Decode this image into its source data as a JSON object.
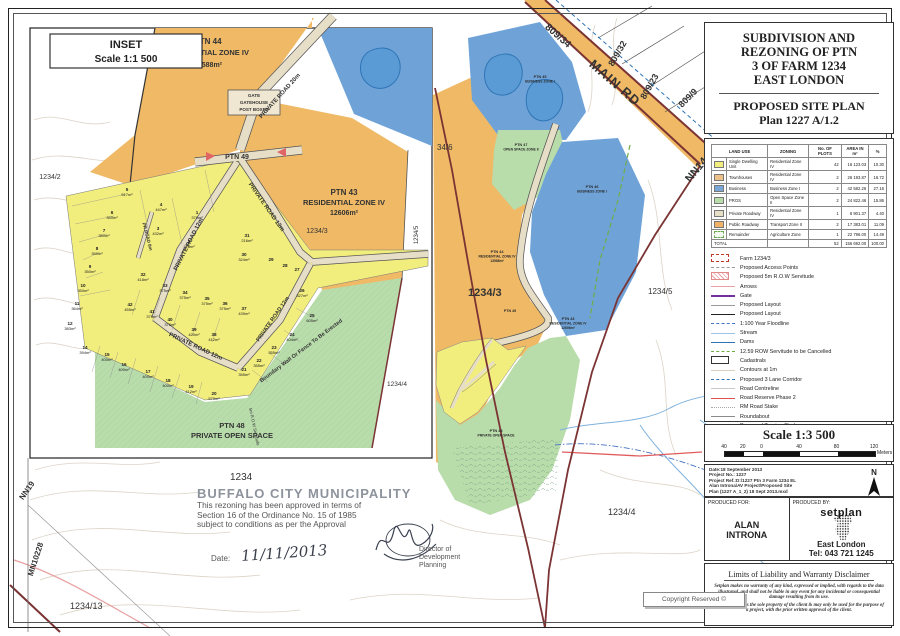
{
  "title_block": {
    "line1": "SUBDIVISION AND",
    "line2": "REZONING OF PTN",
    "line3": "3  OF FARM 1234",
    "line4": "EAST LONDON",
    "sub1": "PROPOSED SITE PLAN",
    "sub2": "Plan 1227 A/1.2"
  },
  "legend_table": {
    "headers": {
      "land_use": "LAND USE",
      "zoning": "ZONING",
      "plots": "No. OF PLOTS",
      "area": "AREA IN m²",
      "pct": "%"
    },
    "rows": [
      {
        "land_use": "Single Dwelling Unit",
        "zoning": "Residential Zone IV",
        "plots": "42",
        "area": "16 123.03",
        "pct": "10.30"
      },
      {
        "land_use": "Townhouses",
        "zoning": "Residential Zone IV",
        "plots": "2",
        "area": "26 193.87",
        "pct": "16.72"
      },
      {
        "land_use": "Business",
        "zoning": "Business Zone I",
        "plots": "2",
        "area": "42 582.26",
        "pct": "27.16"
      },
      {
        "land_use": "PROS",
        "zoning": "Open Space Zone II",
        "plots": "2",
        "area": "24 822.46",
        "pct": "15.86"
      },
      {
        "land_use": "Private Roadway",
        "zoning": "Residential Zone IV",
        "plots": "1",
        "area": "6 901.37",
        "pct": "4.40"
      },
      {
        "land_use": "Public Roadway",
        "zoning": "Transport Zone II",
        "plots": "2",
        "area": "17 383.01",
        "pct": "11.09"
      },
      {
        "land_use": "Remainder",
        "zoning": "Agriculture Zone",
        "plots": "1",
        "area": "22 796.00",
        "pct": "14.49"
      }
    ],
    "total": {
      "label": "TOTAL",
      "plots": "52",
      "area": "156 692.00",
      "pct": "100.00"
    }
  },
  "legend_items": [
    "Farm 1234/3",
    "Proposed Access Points",
    "Proposed 5m R.O.W Servitude",
    "Arrows",
    "Gate",
    "Proposed Layout",
    "Proposed Layout",
    "1:100 Year Floodline",
    "Stream",
    "Dams",
    "12.59 ROW Servitude to be Cancelled",
    "Cadastrals",
    "Contours at 1m",
    "Proposed 3 Lane Corridor",
    "Road Centreline",
    "Road Reserve Phase 2",
    "RM Road Stake",
    "Roundabout",
    "Proposed Turning Circle"
  ],
  "scale_bar": {
    "title": "Scale 1:3 500",
    "ticks": [
      "40",
      "20",
      "0",
      "40",
      "80",
      "120"
    ],
    "unit": "Meters"
  },
  "project_info": {
    "l1": "Date:18 September 2013",
    "l2": "Project No.: 1227",
    "l3": "Project Ref.:D:\\1227 Ptn 3 Farm 1234 EL",
    "l4": "Alan Introna\\AV Project\\Proposed Site",
    "l5": "Plan (1227 A_1_2) 18 Sept 2013.mxd",
    "north": "N"
  },
  "produced": {
    "for_label": "PRODUCED FOR:",
    "for_line1": "ALAN",
    "for_line2": "INTRONA",
    "by_label": "PRODUCED BY:",
    "logo": "setplan",
    "city": "East London",
    "tel": "Tel: 043 721 1245"
  },
  "disclaimer": {
    "title": "Limits of Liability and Warranty Disclaimer",
    "p1": "Setplan makes no warranty of any kind, expressed or implied, with regards to the data illustrated, and shall not be liable in any event for any incidental or consequential damage resulting from its use.",
    "p2": "The data remains the sole property of the client & may only be used for the purpose of a project, with the prior written approval of the client."
  },
  "approval": {
    "title": "BUFFALO CITY MUNICIPALITY",
    "l1": "This rezoning has been approved in terms of",
    "l2": "Section 16 of the Ordinance No. 15 of 1985",
    "l3": "subject to conditions as per the Approval",
    "date_label": "Date:",
    "date_value": "11/11/2013",
    "signer1": "Director of",
    "signer2": "Development Planning"
  },
  "copyright": "Copyright Reserved ©",
  "inset": {
    "title": "INSET",
    "scale": "Scale 1:1 500",
    "ptn44": {
      "l1": "PTN 44",
      "l2": "RESIDENTIAL ZONE IV",
      "l3": "13588m²"
    },
    "ptn43": {
      "l1": "PTN 43",
      "l2": "RESIDENTIAL ZONE IV",
      "l3": "12606m²"
    },
    "ptn48": {
      "l1": "PTN 48",
      "l2": "PRIVATE OPEN SPACE"
    },
    "ptn49": "PTN 49",
    "gate": {
      "l1": "GATE",
      "l2": "GATEHOUSE",
      "l3": "POST BOXES"
    },
    "roads": {
      "r20": "PRIVATE ROAD 20m",
      "r12": "PRIVATE ROAD 12m",
      "r8": "PR ROAD 8m"
    },
    "servitude": "5m R.O.W Servitude",
    "boundary_wall": "Boundary Wall Or Fence To Be Erected",
    "neighbors": {
      "n1234_6": "1234/6",
      "n1234_2": "1234/2",
      "n1234_3": "1234/3",
      "n1234_4": "1234/4",
      "n1234_5": "1234/5"
    },
    "lots": [
      {
        "n": "1",
        "a": "379m²"
      },
      {
        "n": "2",
        "a": "328m²"
      },
      {
        "n": "3",
        "a": "432m²"
      },
      {
        "n": "4",
        "a": "447m²"
      },
      {
        "n": "5",
        "a": "517m²"
      },
      {
        "n": "6",
        "a": "350m²"
      },
      {
        "n": "7",
        "a": "350m²"
      },
      {
        "n": "8",
        "a": "350m²"
      },
      {
        "n": "9",
        "a": "350m²"
      },
      {
        "n": "10",
        "a": "350m²"
      },
      {
        "n": "11",
        "a": "364m²"
      },
      {
        "n": "12",
        "a": "383m²"
      },
      {
        "n": "14",
        "a": "394m²"
      },
      {
        "n": "15",
        "a": "400m²"
      },
      {
        "n": "16",
        "a": "400m²"
      },
      {
        "n": "17",
        "a": "400m²"
      },
      {
        "n": "18",
        "a": "400m²"
      },
      {
        "n": "19",
        "a": "412m²"
      },
      {
        "n": "20",
        "a": "579m²"
      },
      {
        "n": "21",
        "a": "355m²"
      },
      {
        "n": "22",
        "a": "355m²"
      },
      {
        "n": "23",
        "a": "355m²"
      },
      {
        "n": "24",
        "a": "404m²"
      },
      {
        "n": "25",
        "a": "605m²"
      },
      {
        "n": "26",
        "a": "327m²"
      },
      {
        "n": "27",
        "a": ""
      },
      {
        "n": "28",
        "a": ""
      },
      {
        "n": "29",
        "a": ""
      },
      {
        "n": "30",
        "a": "324m²"
      },
      {
        "n": "31",
        "a": "216m²"
      },
      {
        "n": "32",
        "a": "418m²"
      },
      {
        "n": "33",
        "a": "375m²"
      },
      {
        "n": "34",
        "a": "375m²"
      },
      {
        "n": "35",
        "a": "375m²"
      },
      {
        "n": "36",
        "a": "375m²"
      },
      {
        "n": "37",
        "a": "439m²"
      },
      {
        "n": "38",
        "a": "412m²"
      },
      {
        "n": "39",
        "a": "420m²"
      },
      {
        "n": "40",
        "a": "375m²"
      },
      {
        "n": "41",
        "a": "375m²"
      },
      {
        "n": "42",
        "a": "455m²"
      }
    ]
  },
  "map": {
    "main_rd": "MAIN RD",
    "p809_34": "809/34",
    "p809_32": "809/32",
    "p809_23": "809/23",
    "p809_9": "809/9",
    "nn14": "NN14",
    "nn19": "NN19",
    "mn10228": "MN10228",
    "p34_6": "34/6",
    "p1234": "1234",
    "p1234_3": "1234/3",
    "p1234_4": "1234/4",
    "p1234_4b": "1234/4",
    "p1234_5": "1234/5",
    "p1234_13": "1234/13",
    "z45": {
      "l1": "PTN 45",
      "l2": "BUSINESS ZONE I"
    },
    "z46": {
      "l1": "PTN 46",
      "l2": "BUSINESS ZONE I"
    },
    "z47": {
      "l1": "PTN 47",
      "l2": "OPEN SPACE ZONE II"
    },
    "z44": {
      "l1": "PTN 44",
      "l2": "RESIDENTIAL ZONE IV",
      "l3": "13588m²"
    },
    "z43": {
      "l1": "PTN 43",
      "l2": "RESIDENTIAL ZONE IV",
      "l3": "12606m²"
    },
    "z48": {
      "l1": "PTN 48",
      "l2": "PRIVATE OPEN SPACE"
    },
    "z49": "PTN 49"
  },
  "colors": {
    "residential": "#efb966",
    "lots_yellow": "#f2ee7d",
    "business_blue": "#6fa3d8",
    "open_space_green": "#b9dcab",
    "road_beige": "#e7dec7",
    "boundary_maroon": "#7b3333",
    "reserve_red": "#e05c5c"
  }
}
